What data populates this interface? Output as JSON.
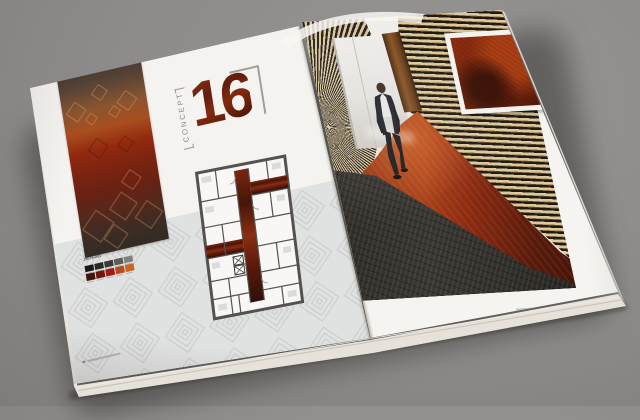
{
  "scene": {
    "subject": "Open carpet-design brochure spread lying on a gray surface"
  },
  "left_page": {
    "concept_label": "CONCEPT",
    "concept_number": "16",
    "palette": {
      "code": "16076-A01",
      "row1_grays": [
        "#181817",
        "#2a2827",
        "#3b3937",
        "#5d5b58",
        "#82807d"
      ],
      "row2_reds": [
        "#41130d",
        "#70150e",
        "#9e1d10",
        "#b84a1b",
        "#c9671f"
      ]
    },
    "floor_plan": {
      "wall_color": "#54524e",
      "corridor_color": "#6e2114"
    },
    "carpet_sample_colors": [
      "#433a34",
      "#a84e1f",
      "#7c2410",
      "#332b25"
    ],
    "pattern_band_color": "#e0e2e1"
  },
  "right_page": {
    "photo": {
      "subject": "man in dark suit walking down corridor",
      "slat_wood_color": "#dcc89c",
      "red_carpet_color": "#8a2c12",
      "dark_carpet_color": "#343230"
    },
    "inset": {
      "subject": "red carpet texture detail",
      "base_color": "#7e2410"
    }
  },
  "backdrop_color": "#8d8b89",
  "page_color": "#f4f3f0"
}
